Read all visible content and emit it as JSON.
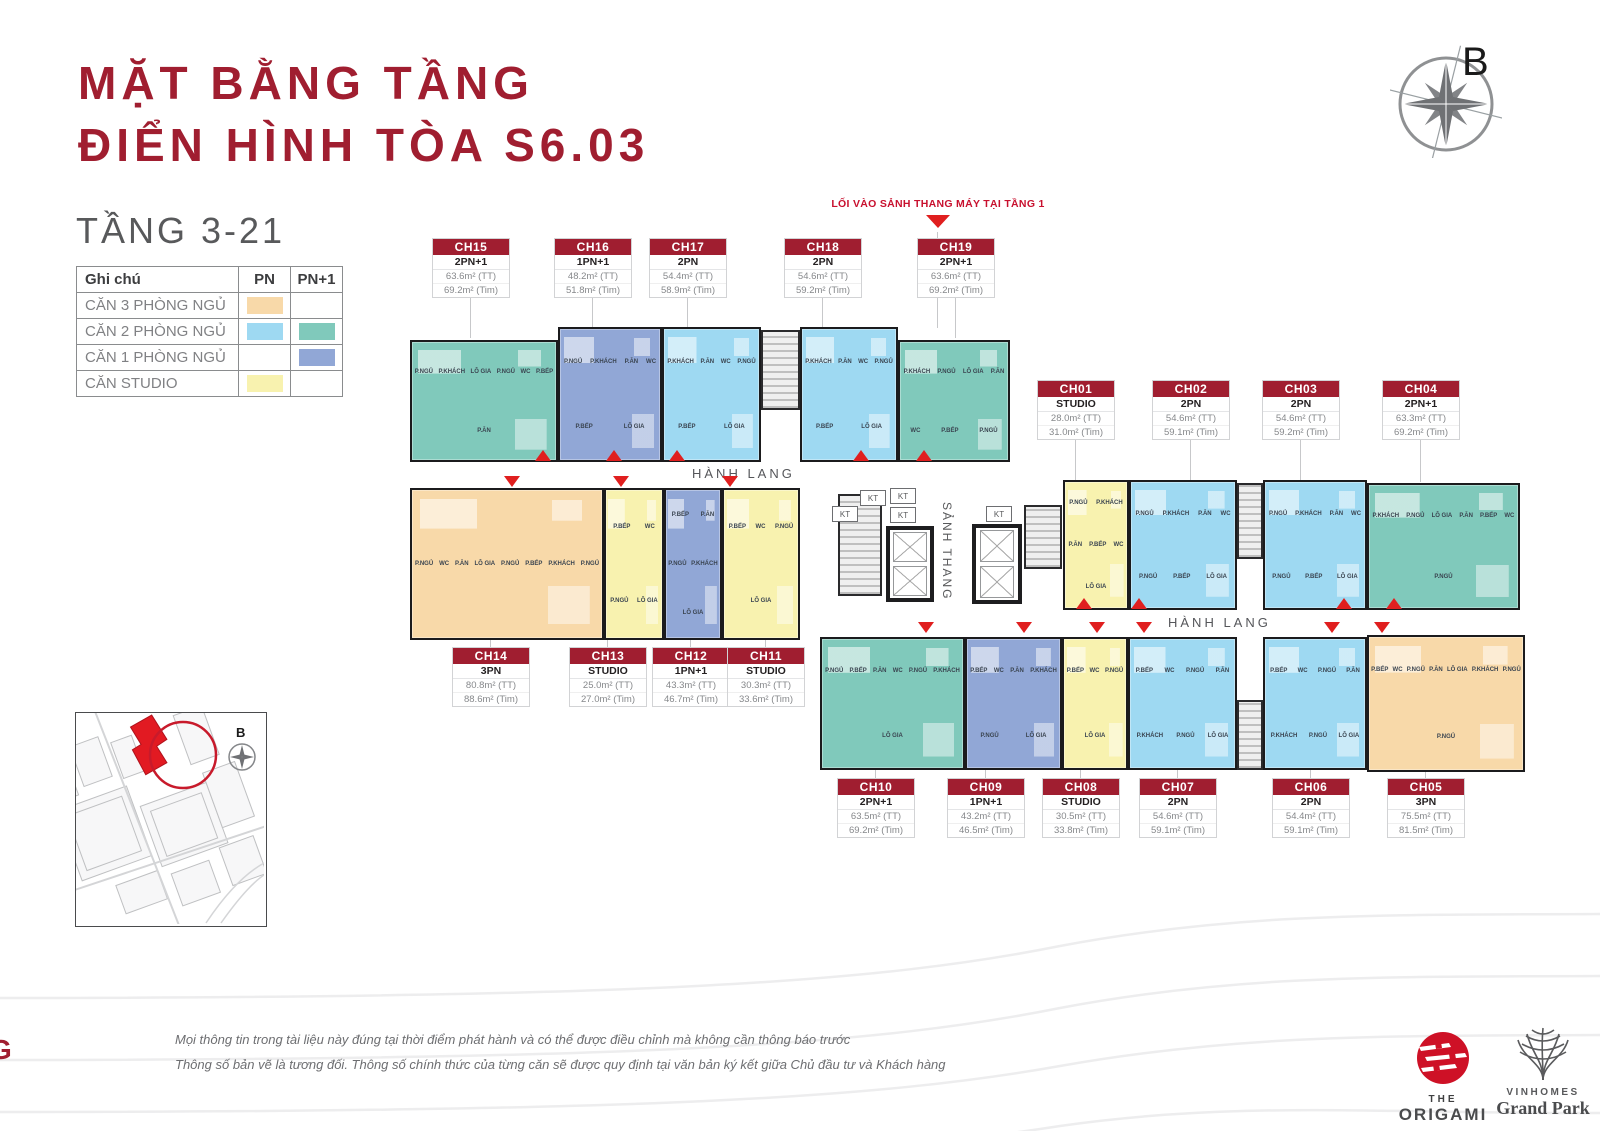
{
  "colors": {
    "red": "#A01E30",
    "arrow_red": "#E01F1F",
    "pn3": "#F8D9A9",
    "pn2": "#9ED9F2",
    "pn2plus": "#80C9BB",
    "pn1plus": "#91A7D6",
    "studio": "#F8F2AF"
  },
  "header": {
    "title_line1": "MẶT BẰNG TẦNG",
    "title_line2": "ĐIỂN HÌNH TÒA S6.03",
    "floors": "TẦNG 3-21",
    "compass_label": "B"
  },
  "legend": {
    "header": {
      "note": "Ghi chú",
      "pn": "PN",
      "pn_plus": "PN+1"
    },
    "rows": [
      {
        "label": "CĂN 3 PHÒNG NGỦ"
      },
      {
        "label": "CĂN 2 PHÒNG NGỦ"
      },
      {
        "label": "CĂN 1 PHÒNG NGỦ"
      },
      {
        "label": "CĂN STUDIO"
      }
    ]
  },
  "plan": {
    "corridor_left": "HÀNH LANG",
    "corridor_right": "HÀNH LANG",
    "lobby_vertical": "SẢNH THANG",
    "shaft": "KT",
    "entry_note": "LỐI VÀO SẢNH THANG MÁY TẠI TẦNG 1"
  },
  "units": {
    "CH01": {
      "id": "CH01",
      "type": "STUDIO",
      "area_tt": "28.0m² (TT)",
      "area_tim": "31.0m² (Tim)",
      "color": "studio",
      "rooms": [
        "P.NGỦ",
        "P.KHÁCH",
        "P.ĂN",
        "P.BẾP",
        "WC",
        "LÔ GIA"
      ]
    },
    "CH02": {
      "id": "CH02",
      "type": "2PN",
      "area_tt": "54.6m² (TT)",
      "area_tim": "59.1m² (Tim)",
      "color": "pn2",
      "rooms": [
        "P.NGỦ",
        "P.KHÁCH",
        "P.ĂN",
        "WC",
        "P.NGỦ",
        "P.BẾP",
        "LÔ GIA"
      ]
    },
    "CH03": {
      "id": "CH03",
      "type": "2PN",
      "area_tt": "54.6m² (TT)",
      "area_tim": "59.2m² (Tim)",
      "color": "pn2",
      "rooms": [
        "P.NGỦ",
        "P.KHÁCH",
        "P.ĂN",
        "WC",
        "P.NGỦ",
        "P.BẾP",
        "LÔ GIA"
      ]
    },
    "CH04": {
      "id": "CH04",
      "type": "2PN+1",
      "area_tt": "63.3m² (TT)",
      "area_tim": "69.2m² (Tim)",
      "color": "pn2plus",
      "rooms": [
        "P.KHÁCH",
        "P.NGỦ",
        "LÔ GIA",
        "P.ĂN",
        "P.BẾP",
        "WC",
        "P.NGỦ"
      ]
    },
    "CH05": {
      "id": "CH05",
      "type": "3PN",
      "area_tt": "75.5m² (TT)",
      "area_tim": "81.5m² (Tim)",
      "color": "pn3",
      "rooms": [
        "P.BẾP",
        "WC",
        "P.NGỦ",
        "P.ĂN",
        "LÔ GIA",
        "P.KHÁCH",
        "P.NGỦ",
        "P.NGỦ"
      ]
    },
    "CH06": {
      "id": "CH06",
      "type": "2PN",
      "area_tt": "54.4m² (TT)",
      "area_tim": "59.1m² (Tim)",
      "color": "pn2",
      "rooms": [
        "P.BẾP",
        "WC",
        "P.NGỦ",
        "P.ĂN",
        "P.KHÁCH",
        "P.NGỦ",
        "LÔ GIA"
      ]
    },
    "CH07": {
      "id": "CH07",
      "type": "2PN",
      "area_tt": "54.6m² (TT)",
      "area_tim": "59.1m² (Tim)",
      "color": "pn2",
      "rooms": [
        "P.BẾP",
        "WC",
        "P.NGỦ",
        "P.ĂN",
        "P.KHÁCH",
        "P.NGỦ",
        "LÔ GIA"
      ]
    },
    "CH08": {
      "id": "CH08",
      "type": "STUDIO",
      "area_tt": "30.5m² (TT)",
      "area_tim": "33.8m² (Tim)",
      "color": "studio",
      "rooms": [
        "P.BẾP",
        "WC",
        "P.NGỦ",
        "LÔ GIA"
      ]
    },
    "CH09": {
      "id": "CH09",
      "type": "1PN+1",
      "area_tt": "43.2m² (TT)",
      "area_tim": "46.5m² (Tim)",
      "color": "pn1plus",
      "rooms": [
        "P.BẾP",
        "WC",
        "P.ĂN",
        "P.KHÁCH",
        "P.NGỦ",
        "LÔ GIA"
      ]
    },
    "CH10": {
      "id": "CH10",
      "type": "2PN+1",
      "area_tt": "63.5m² (TT)",
      "area_tim": "69.2m² (Tim)",
      "color": "pn2plus",
      "rooms": [
        "P.NGỦ",
        "P.BẾP",
        "P.ĂN",
        "WC",
        "P.NGỦ",
        "P.KHÁCH",
        "LÔ GIA"
      ]
    },
    "CH11": {
      "id": "CH11",
      "type": "STUDIO",
      "area_tt": "30.3m² (TT)",
      "area_tim": "33.6m² (Tim)",
      "color": "studio",
      "rooms": [
        "P.BẾP",
        "WC",
        "P.NGỦ",
        "LÔ GIA"
      ]
    },
    "CH12": {
      "id": "CH12",
      "type": "1PN+1",
      "area_tt": "43.3m² (TT)",
      "area_tim": "46.7m² (Tim)",
      "color": "pn1plus",
      "rooms": [
        "P.BẾP",
        "P.ĂN",
        "P.NGỦ",
        "P.KHÁCH",
        "LÔ GIA"
      ]
    },
    "CH13": {
      "id": "CH13",
      "type": "STUDIO",
      "area_tt": "25.0m² (TT)",
      "area_tim": "27.0m² (Tim)",
      "color": "studio",
      "rooms": [
        "P.BẾP",
        "WC",
        "P.NGỦ",
        "LÔ GIA"
      ]
    },
    "CH14": {
      "id": "CH14",
      "type": "3PN",
      "area_tt": "80.8m² (TT)",
      "area_tim": "88.6m² (Tim)",
      "color": "pn3",
      "rooms": [
        "P.NGỦ",
        "WC",
        "P.ĂN",
        "LÔ GIA",
        "P.NGỦ",
        "P.BẾP",
        "P.KHÁCH",
        "P.NGỦ"
      ]
    },
    "CH15": {
      "id": "CH15",
      "type": "2PN+1",
      "area_tt": "63.6m² (TT)",
      "area_tim": "69.2m² (Tim)",
      "color": "pn2plus",
      "rooms": [
        "P.NGỦ",
        "P.KHÁCH",
        "LÔ GIA",
        "P.NGỦ",
        "WC",
        "P.BẾP",
        "P.ĂN"
      ]
    },
    "CH16": {
      "id": "CH16",
      "type": "1PN+1",
      "area_tt": "48.2m² (TT)",
      "area_tim": "51.8m² (Tim)",
      "color": "pn1plus",
      "rooms": [
        "P.NGỦ",
        "P.KHÁCH",
        "P.ĂN",
        "WC",
        "P.BẾP",
        "LÔ GIA"
      ]
    },
    "CH17": {
      "id": "CH17",
      "type": "2PN",
      "area_tt": "54.4m² (TT)",
      "area_tim": "58.9m² (Tim)",
      "color": "pn2",
      "rooms": [
        "P.KHÁCH",
        "P.ĂN",
        "WC",
        "P.NGỦ",
        "P.BẾP",
        "LÔ GIA"
      ]
    },
    "CH18": {
      "id": "CH18",
      "type": "2PN",
      "area_tt": "54.6m² (TT)",
      "area_tim": "59.2m² (Tim)",
      "color": "pn2",
      "rooms": [
        "P.KHÁCH",
        "P.ĂN",
        "WC",
        "P.NGỦ",
        "P.BẾP",
        "LÔ GIA"
      ]
    },
    "CH19": {
      "id": "CH19",
      "type": "2PN+1",
      "area_tt": "63.6m² (TT)",
      "area_tim": "69.2m² (Tim)",
      "color": "pn2plus",
      "rooms": [
        "P.KHÁCH",
        "P.NGỦ",
        "LÔ GIA",
        "P.ĂN",
        "WC",
        "P.BẾP",
        "P.NGỦ"
      ]
    }
  },
  "site_map": {
    "compass_label": "B"
  },
  "footer": {
    "disclaimer1": "Mọi thông tin trong tài liệu này đúng tại thời điểm phát hành và có thể được điều chỉnh mà không cần thông báo trước",
    "disclaimer2": "Thông số bản vẽ là tương đối. Thông số chính thức của từng căn sẽ được quy định tại văn bản ký kết giữa Chủ đầu tư và Khách hàng",
    "page_letter": "G"
  },
  "logos": {
    "origami": {
      "top": "THE",
      "name": "ORIGAMI"
    },
    "vinhomes": {
      "top": "VINHOMES",
      "name": "Grand Park"
    }
  }
}
